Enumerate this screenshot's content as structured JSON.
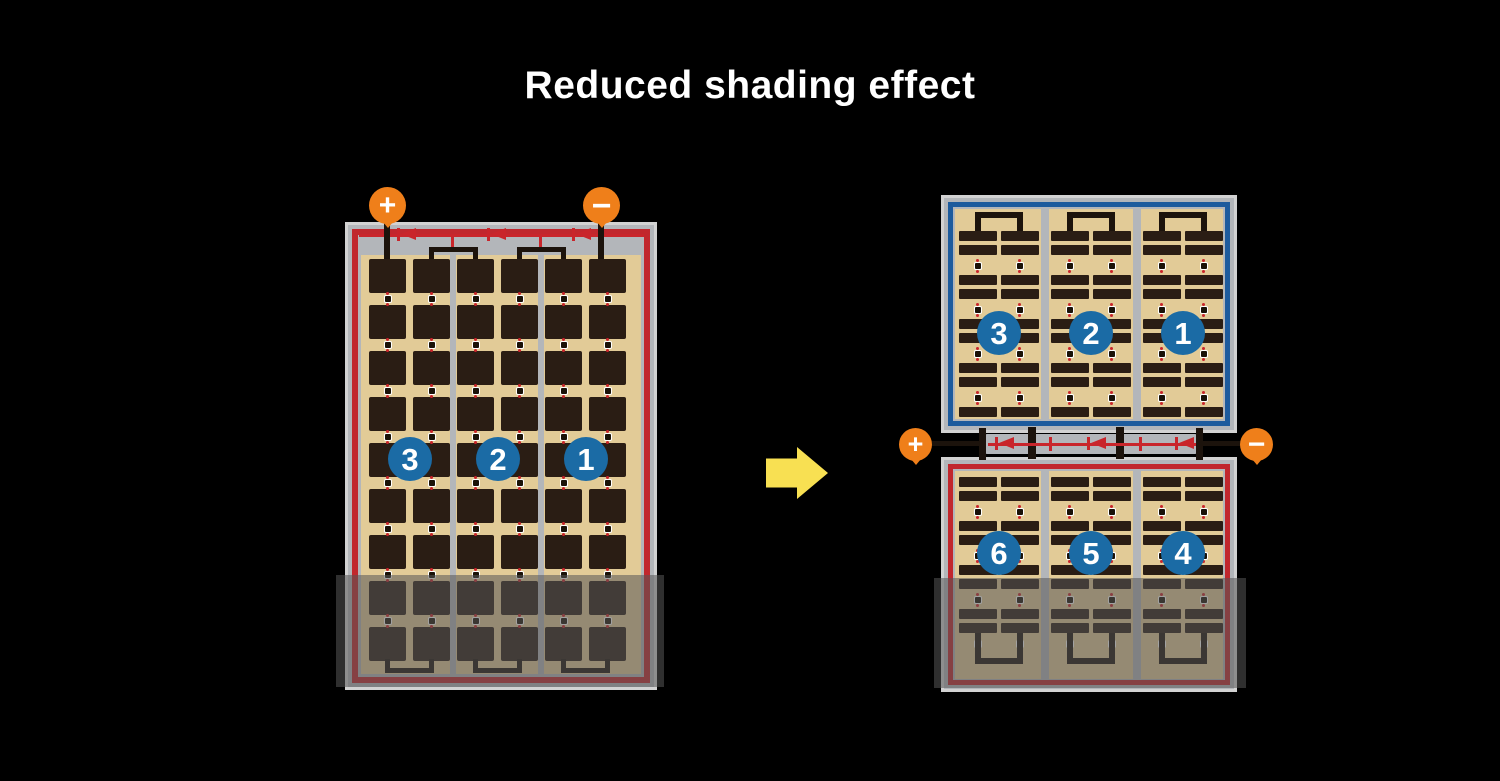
{
  "title": "Reduced shading effect",
  "colors": {
    "background": "#000000",
    "frame_gray": "#b3b6ba",
    "frame_edge": "#d2d2d2",
    "cell_tan": "#e2cb97",
    "cell_dark": "#2a1d14",
    "shaded_tan": "#9c9178",
    "border_red": "#c1272d",
    "border_blue": "#1d5b9d",
    "wire_black": "#1c130c",
    "diode_red": "#c9252b",
    "badge_blue": "#1b6ba5",
    "terminal_orange": "#ef7f1a",
    "arrow_yellow": "#f8e052",
    "shade": "rgba(85,85,85,0.55)"
  },
  "left_panel": {
    "numbers": [
      "3",
      "2",
      "1"
    ],
    "plus": "+",
    "minus": "−"
  },
  "right_panel": {
    "top_numbers": [
      "3",
      "2",
      "1"
    ],
    "bottom_numbers": [
      "6",
      "5",
      "4"
    ],
    "plus": "+",
    "minus": "−"
  }
}
